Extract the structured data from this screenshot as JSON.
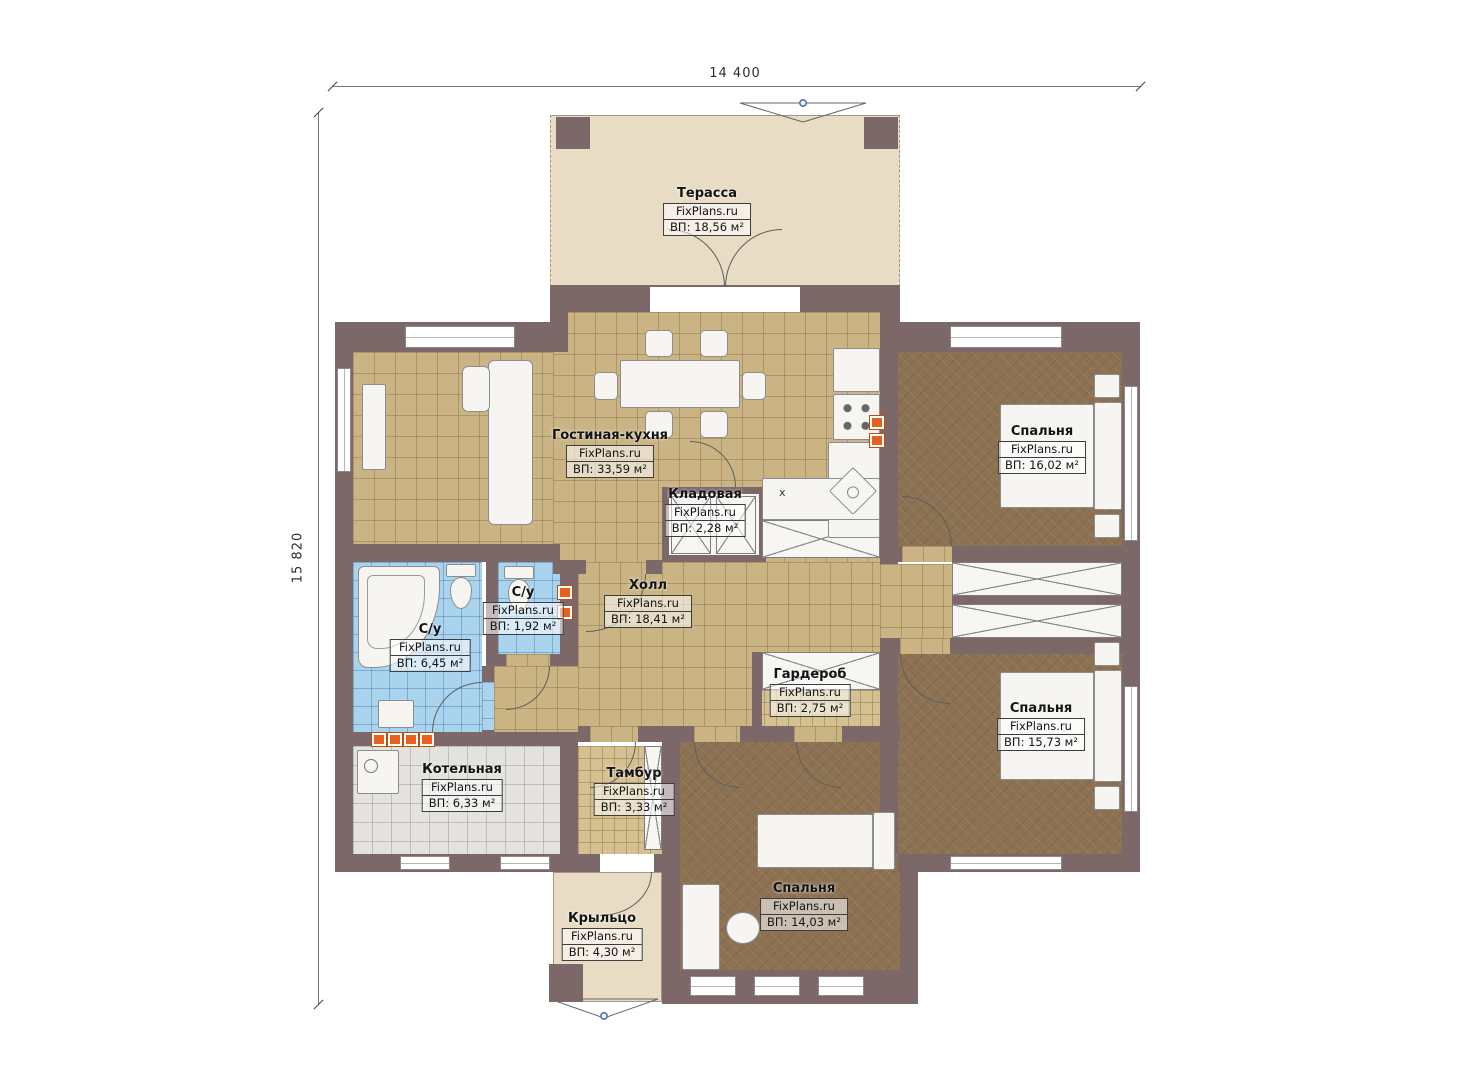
{
  "dimensions": {
    "top": "14 400",
    "left": "15 820"
  },
  "brand": "FixPlans.ru",
  "rooms": [
    {
      "name": "Терасса",
      "brand": "FixPlans.ru",
      "area": "ВП: 18,56 м²"
    },
    {
      "name": "Гостиная-кухня",
      "brand": "FixPlans.ru",
      "area": "ВП: 33,59 м²"
    },
    {
      "name": "Кладовая",
      "brand": "FixPlans.ru",
      "area": "ВП: 2,28 м²"
    },
    {
      "name": "Спальня",
      "brand": "FixPlans.ru",
      "area": "ВП: 16,02 м²"
    },
    {
      "name": "Холл",
      "brand": "FixPlans.ru",
      "area": "ВП: 18,41 м²"
    },
    {
      "name": "С/у",
      "brand": "FixPlans.ru",
      "area": "ВП: 6,45 м²"
    },
    {
      "name": "С/у",
      "brand": "FixPlans.ru",
      "area": "ВП: 1,92 м²"
    },
    {
      "name": "Гардероб",
      "brand": "FixPlans.ru",
      "area": "ВП: 2,75 м²"
    },
    {
      "name": "Котельная",
      "brand": "FixPlans.ru",
      "area": "ВП: 6,33 м²"
    },
    {
      "name": "Тамбур",
      "brand": "FixPlans.ru",
      "area": "ВП: 3,33 м²"
    },
    {
      "name": "Спальня",
      "brand": "FixPlans.ru",
      "area": "ВП: 15,73 м²"
    },
    {
      "name": "Спальня",
      "brand": "FixPlans.ru",
      "area": "ВП: 14,03 м²"
    },
    {
      "name": "Крыльцо",
      "brand": "FixPlans.ru",
      "area": "ВП: 4,30 м²"
    }
  ],
  "symbols": {
    "counter_mark": "х"
  },
  "colors": {
    "wall": "#7c6769",
    "floor_tile": "#cab484",
    "floor_dark": "#8c7252",
    "floor_blue": "#aad3ee",
    "floor_gray": "#e3e2df",
    "terrace": "#e8dcc5",
    "hatch": "#d5c091",
    "radiator": "#e8611c",
    "marker_blue": "#4a69ad"
  }
}
